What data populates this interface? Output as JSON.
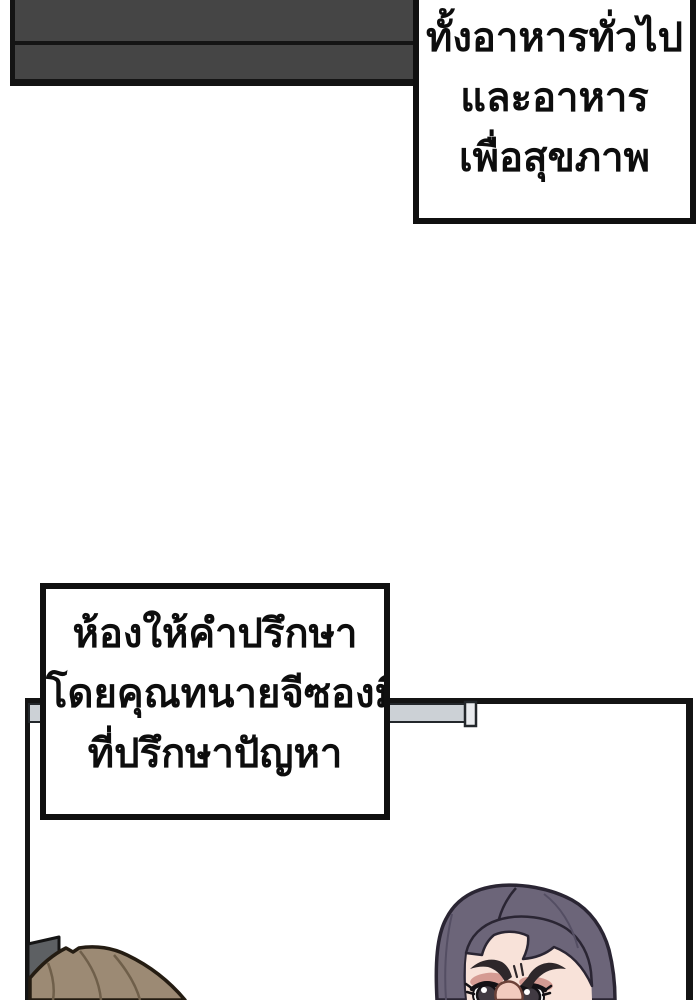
{
  "panel": {
    "type": "webtoon-comic-panel",
    "background": "#ffffff"
  },
  "speech_bubbles": [
    {
      "id": "bubble-food",
      "position": "top-right",
      "lines": [
        "ทั้งอาหารทั่วไป",
        "และอาหาร",
        "เพื่อสุขภาพ"
      ]
    },
    {
      "id": "bubble-consult",
      "position": "middle-left",
      "lines": [
        "ห้องให้คำปรึกษา",
        "โดยคุณทนายจีซองมี",
        "ที่ปรึกษาปัญหา"
      ]
    }
  ],
  "scene": {
    "elements": [
      "dark-signboard-top-left",
      "room-wall-corner-lines",
      "wall-rail-gray-bar",
      "door-hinge-plate",
      "brown-haired-head-bottom-left",
      "purple-haired-frowning-woman-bottom-right"
    ]
  },
  "colors": {
    "outline": "#141414",
    "sign": "#454545",
    "bubbleBg": "#ffffff",
    "bubbleBorder": "#101010",
    "rail": "#ccd1d6",
    "railCap": "#e9ebee",
    "railEdge": "#23272b",
    "hinge": "#5d6063",
    "leftHair": "#9c8a74",
    "leftHairLine": "#6f5f4a",
    "leftHairOutline": "#241c12",
    "rightHair": "#6c6579",
    "rightHairOutline": "#2a2533",
    "rightHairStrand": "#544e63",
    "skin": "#f8e2d9",
    "eyeshadow": "#c9837b",
    "brow": "#2e272a",
    "iris": "#413a42",
    "eyeOutline": "#141115",
    "noseFill": "#f2cbbf",
    "noseLine": "#6b4138"
  }
}
